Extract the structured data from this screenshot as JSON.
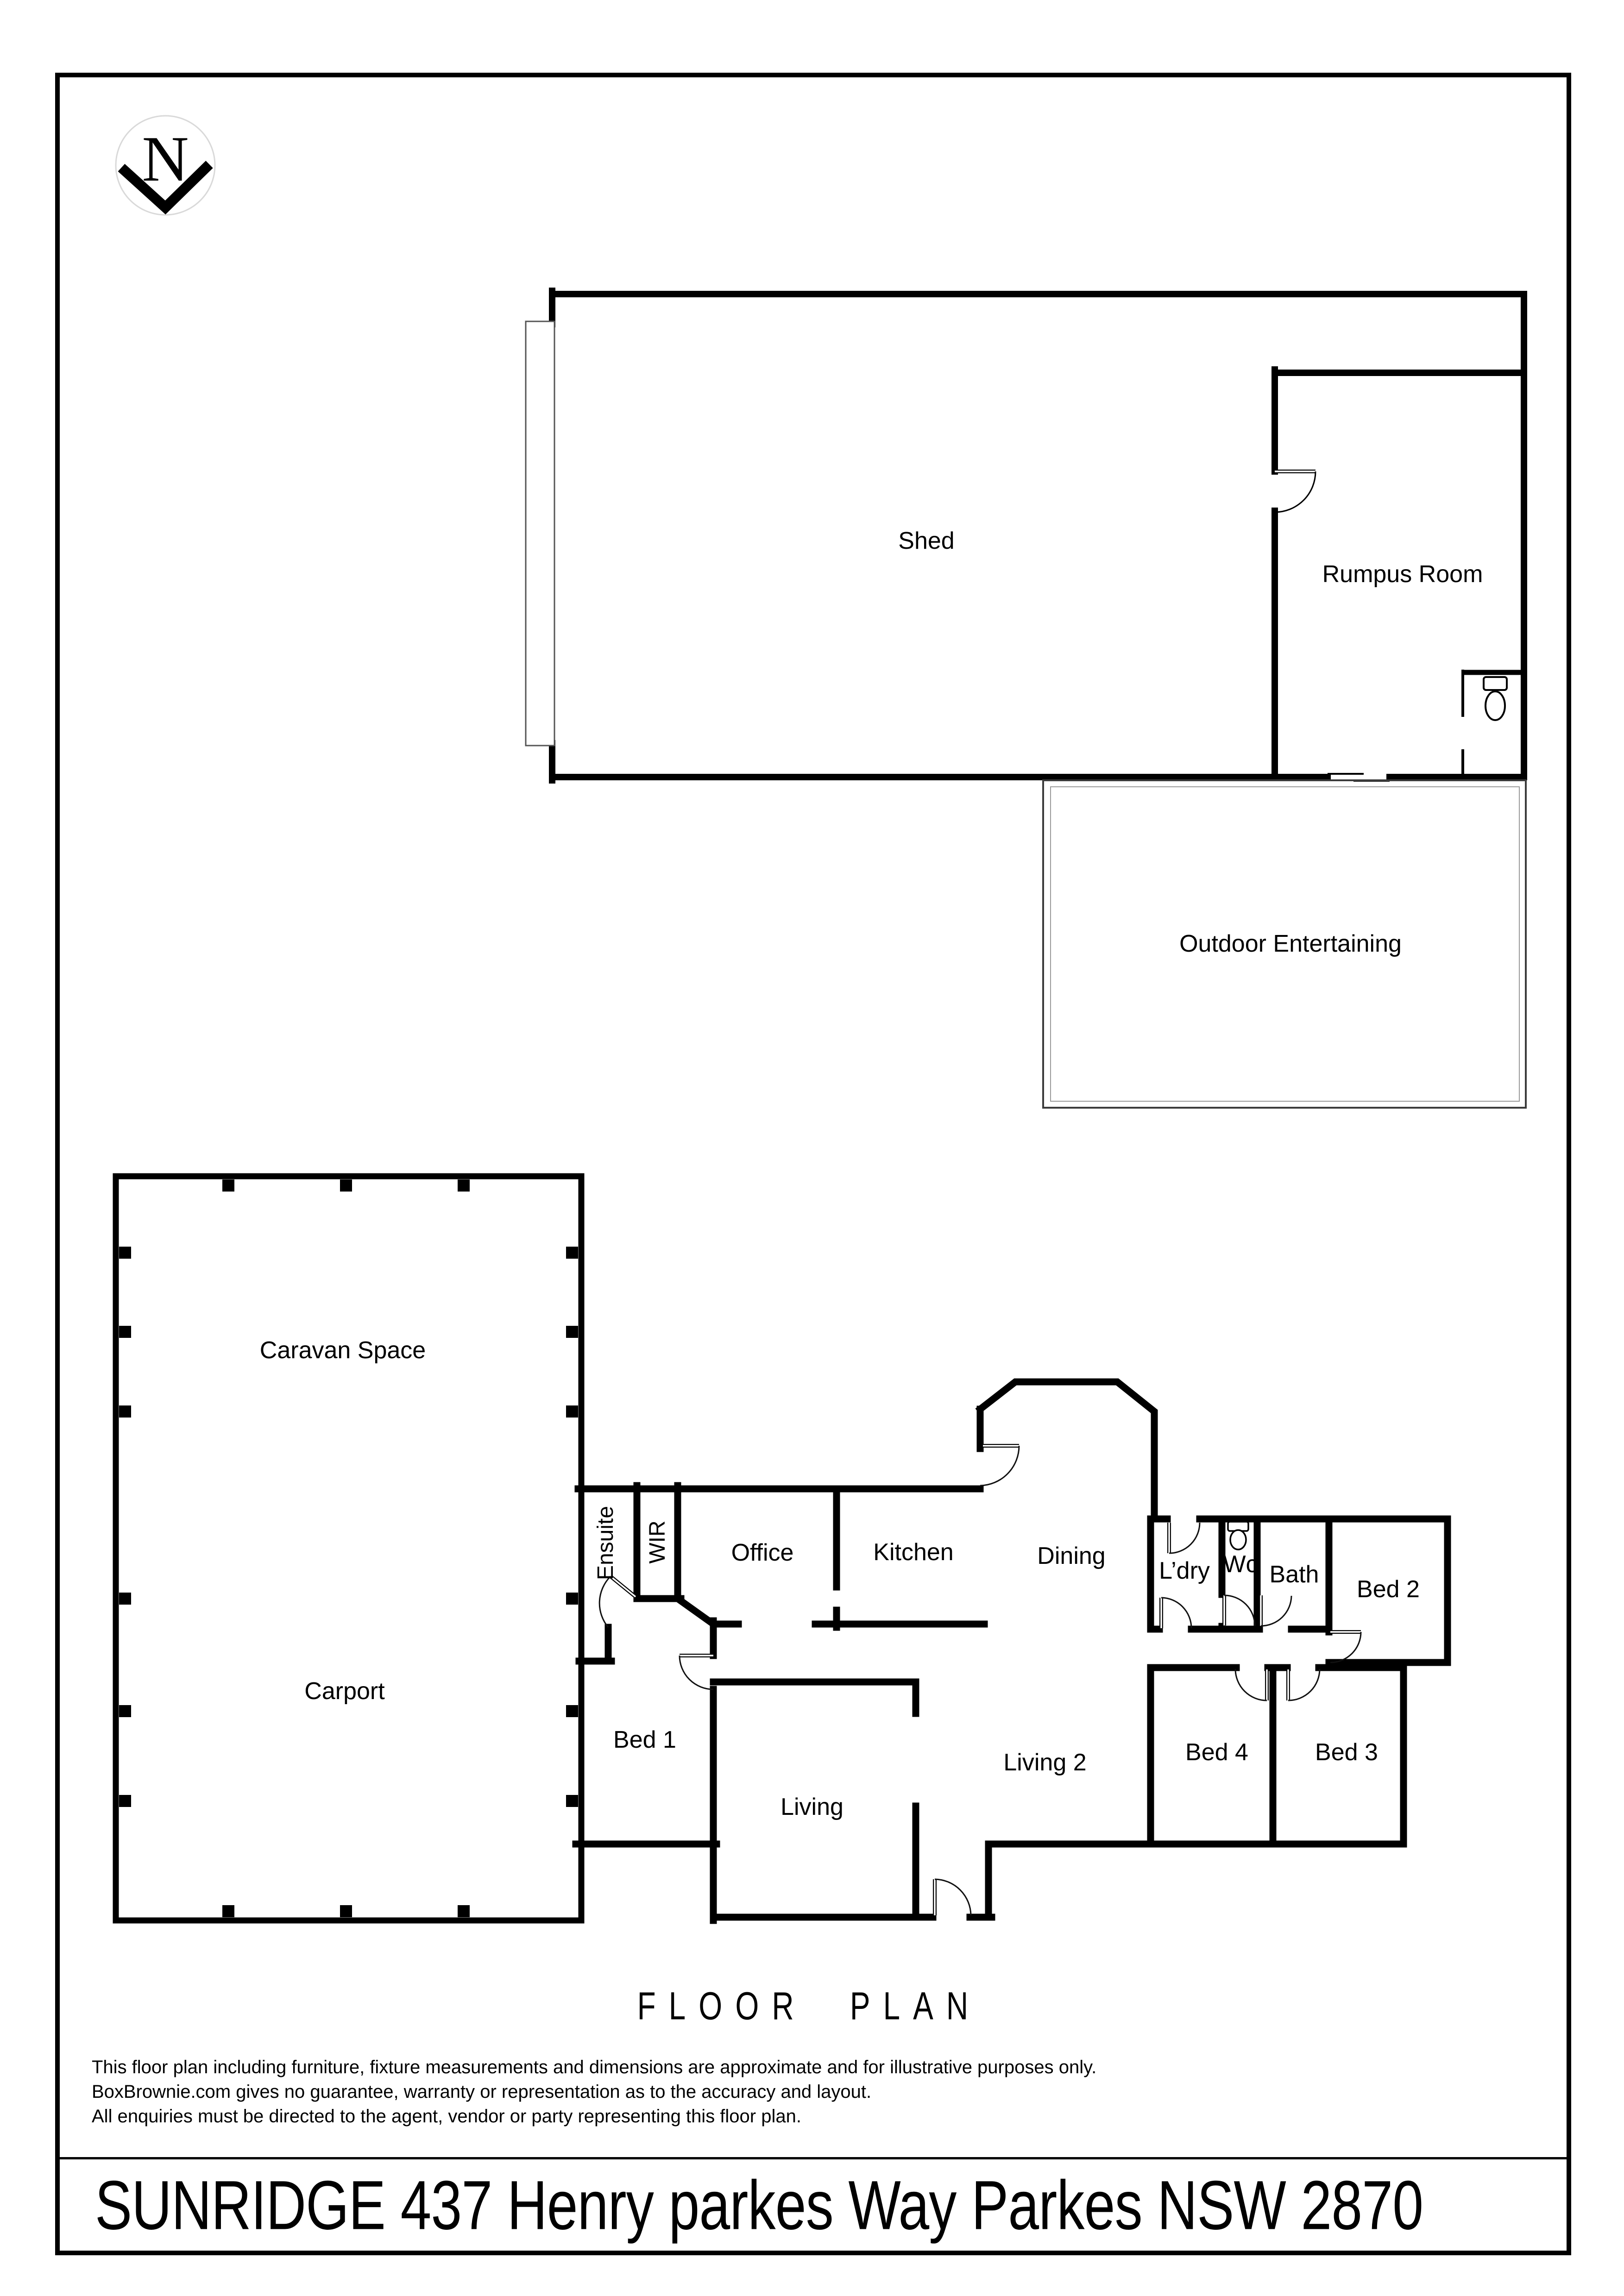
{
  "north": {
    "letter": "N"
  },
  "rooms": {
    "shed": "Shed",
    "rumpus_room": "Rumpus Room",
    "outdoor_entertaining": "Outdoor Entertaining",
    "caravan_space": "Caravan Space",
    "carport": "Carport",
    "ensuite": "Ensuite",
    "wir": "WIR",
    "office": "Office",
    "kitchen": "Kitchen",
    "dining": "Dining",
    "laundry": "L’dry",
    "wc": "Wc",
    "bath": "Bath",
    "bed1": "Bed 1",
    "bed2": "Bed 2",
    "bed3": "Bed 3",
    "bed4": "Bed 4",
    "living": "Living",
    "living2": "Living 2"
  },
  "title": "FLOOR PLAN",
  "disclaimer": {
    "line1": "This floor plan including furniture, fixture measurements and dimensions are approximate and for illustrative purposes only.",
    "line2": "BoxBrownie.com gives no guarantee, warranty or representation as to the accuracy and layout.",
    "line3": "All enquiries must be directed to the agent, vendor or party representing this floor plan."
  },
  "address": "SUNRIDGE 437 Henry parkes Way Parkes NSW 2870"
}
